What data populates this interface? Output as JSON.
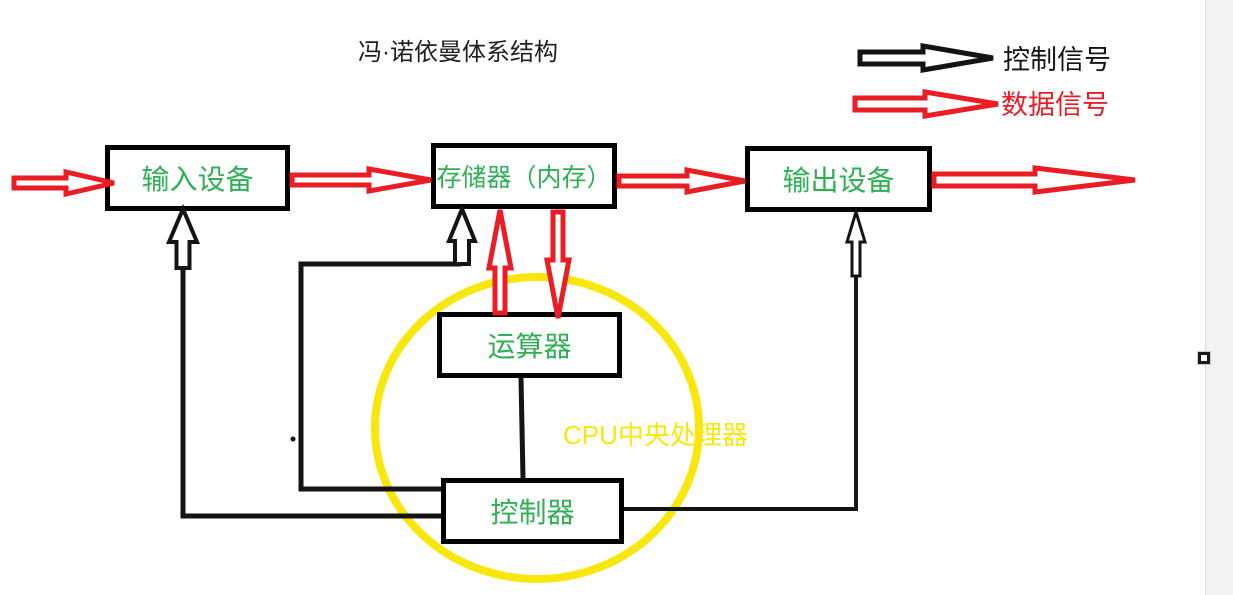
{
  "window": {
    "width": 1233,
    "height": 595,
    "canvas_width": 1205,
    "canvas_color": "#ffffff",
    "panel_color": "#f2f2f2",
    "divider_color": "#dcdcdc"
  },
  "colors": {
    "control_signal": "#141414",
    "data_signal": "#ea1c24",
    "box_border": "#000000",
    "box_text": "#2fb055",
    "cpu_yellow": "#f7e70d",
    "title_text": "#1f1f1f"
  },
  "title": {
    "text": "冯·诺依曼体系结构",
    "x": 358,
    "y": 40,
    "size": 24,
    "color": "#1f1f1f"
  },
  "legend": {
    "items": [
      {
        "label": "控制信号",
        "signal": "control",
        "color": "#141414",
        "label_x": 1003,
        "label_y": 46,
        "label_size": 27,
        "arrow": {
          "from": [
            860,
            58
          ],
          "to": [
            993,
            58
          ],
          "shaft": 6,
          "head_len": 70,
          "head_half": 12,
          "stroke": 5
        }
      },
      {
        "label": "数据信号",
        "signal": "data",
        "color": "#ea1c24",
        "label_x": 1001,
        "label_y": 91,
        "label_size": 27,
        "arrow": {
          "from": [
            855,
            104
          ],
          "to": [
            998,
            104
          ],
          "shaft": 6,
          "head_len": 73,
          "head_half": 12,
          "stroke": 5
        }
      }
    ]
  },
  "boxes": [
    {
      "id": "input-device",
      "label": "输入设备",
      "x": 105,
      "y": 145,
      "w": 185,
      "h": 66,
      "font": 28
    },
    {
      "id": "memory",
      "label": "存储器（内存）",
      "x": 431,
      "y": 143,
      "w": 186,
      "h": 66,
      "font": 25
    },
    {
      "id": "output-device",
      "label": "输出设备",
      "x": 745,
      "y": 146,
      "w": 187,
      "h": 66,
      "font": 28
    },
    {
      "id": "alu",
      "label": "运算器",
      "x": 437,
      "y": 312,
      "w": 185,
      "h": 66,
      "font": 28
    },
    {
      "id": "control-unit",
      "label": "控制器",
      "x": 441,
      "y": 478,
      "w": 183,
      "h": 66,
      "font": 28
    }
  ],
  "cpu_region": {
    "label": "CPU中央处理器",
    "label_x": 563,
    "label_y": 421,
    "label_size": 26,
    "label_color": "#f7e70d",
    "circle": {
      "cx": 537,
      "cy": 428,
      "rx": 162,
      "ry": 151,
      "stroke": "#f7e70d",
      "width": 8
    }
  },
  "connections": {
    "control_lines": [
      {
        "name": "line-cu-to-input",
        "from_node": "control-unit",
        "to_node": "input-device",
        "points": [
          [
            441,
            516
          ],
          [
            183,
            516
          ],
          [
            183,
            266
          ]
        ],
        "w": 5
      },
      {
        "name": "line-cu-to-memory",
        "from_node": "control-unit",
        "to_node": "memory",
        "points": [
          [
            441,
            489
          ],
          [
            301,
            489
          ],
          [
            301,
            264
          ],
          [
            459,
            264
          ]
        ],
        "w": 5
      },
      {
        "name": "line-cu-to-output",
        "from_node": "control-unit",
        "to_node": "output-device",
        "points": [
          [
            624,
            509
          ],
          [
            856,
            509
          ],
          [
            856,
            276
          ]
        ],
        "w": 4
      },
      {
        "name": "line-alu-to-cu",
        "from_node": "alu",
        "to_node": "control-unit",
        "points": [
          [
            521,
            378
          ],
          [
            523,
            478
          ]
        ],
        "w": 5
      }
    ],
    "control_arrows": [
      {
        "name": "arrow-cu-to-input",
        "from_node": "control-unit",
        "to_node": "input-device",
        "signal": "control",
        "from": [
          183,
          268
        ],
        "to": [
          183,
          209
        ],
        "shaft": 6.5,
        "head_len": 33,
        "head_half": 14,
        "stroke": 4
      },
      {
        "name": "arrow-cu-to-memory",
        "from_node": "control-unit",
        "to_node": "memory",
        "signal": "control",
        "from": [
          462,
          264
        ],
        "to": [
          462,
          209
        ],
        "shaft": 7,
        "head_len": 32,
        "head_half": 13,
        "stroke": 4
      },
      {
        "name": "arrow-cu-to-output",
        "from_node": "control-unit",
        "to_node": "output-device",
        "signal": "control",
        "from": [
          856,
          276
        ],
        "to": [
          856,
          212
        ],
        "shaft": 4,
        "head_len": 30,
        "head_half": 9,
        "stroke": 3
      }
    ],
    "data_arrows": [
      {
        "name": "arrow-external-to-input",
        "from_node": "external",
        "to_node": "input-device",
        "signal": "data",
        "from": [
          14,
          183
        ],
        "to": [
          114,
          183
        ],
        "shaft": 5,
        "head_len": 48,
        "head_half": 11,
        "stroke": 5
      },
      {
        "name": "arrow-input-to-memory",
        "from_node": "input-device",
        "to_node": "memory",
        "signal": "data",
        "from": [
          292,
          180
        ],
        "to": [
          431,
          180
        ],
        "shaft": 5,
        "head_len": 62,
        "head_half": 11,
        "stroke": 5
      },
      {
        "name": "arrow-memory-to-output",
        "from_node": "memory",
        "to_node": "output-device",
        "signal": "data",
        "from": [
          619,
          181
        ],
        "to": [
          745,
          181
        ],
        "shaft": 5,
        "head_len": 58,
        "head_half": 11,
        "stroke": 5
      },
      {
        "name": "arrow-output-to-external",
        "from_node": "output-device",
        "to_node": "external",
        "signal": "data",
        "from": [
          934,
          180
        ],
        "to": [
          1135,
          180
        ],
        "shaft": 6,
        "head_len": 100,
        "head_half": 12,
        "stroke": 5
      },
      {
        "name": "arrow-alu-to-memory",
        "from_node": "alu",
        "to_node": "memory",
        "signal": "data",
        "from": [
          500,
          313
        ],
        "to": [
          500,
          210
        ],
        "shaft": 5,
        "head_len": 58,
        "head_half": 11,
        "stroke": 5
      },
      {
        "name": "arrow-memory-to-alu",
        "from_node": "memory",
        "to_node": "alu",
        "signal": "data",
        "from": [
          558,
          212
        ],
        "to": [
          558,
          318
        ],
        "shaft": 5,
        "head_len": 58,
        "head_half": 11,
        "stroke": 5
      }
    ],
    "stray_dot": {
      "x": 293,
      "y": 439,
      "r": 2.5
    }
  },
  "resize_handle": {
    "x": 1198,
    "y": 352,
    "size": 12
  }
}
